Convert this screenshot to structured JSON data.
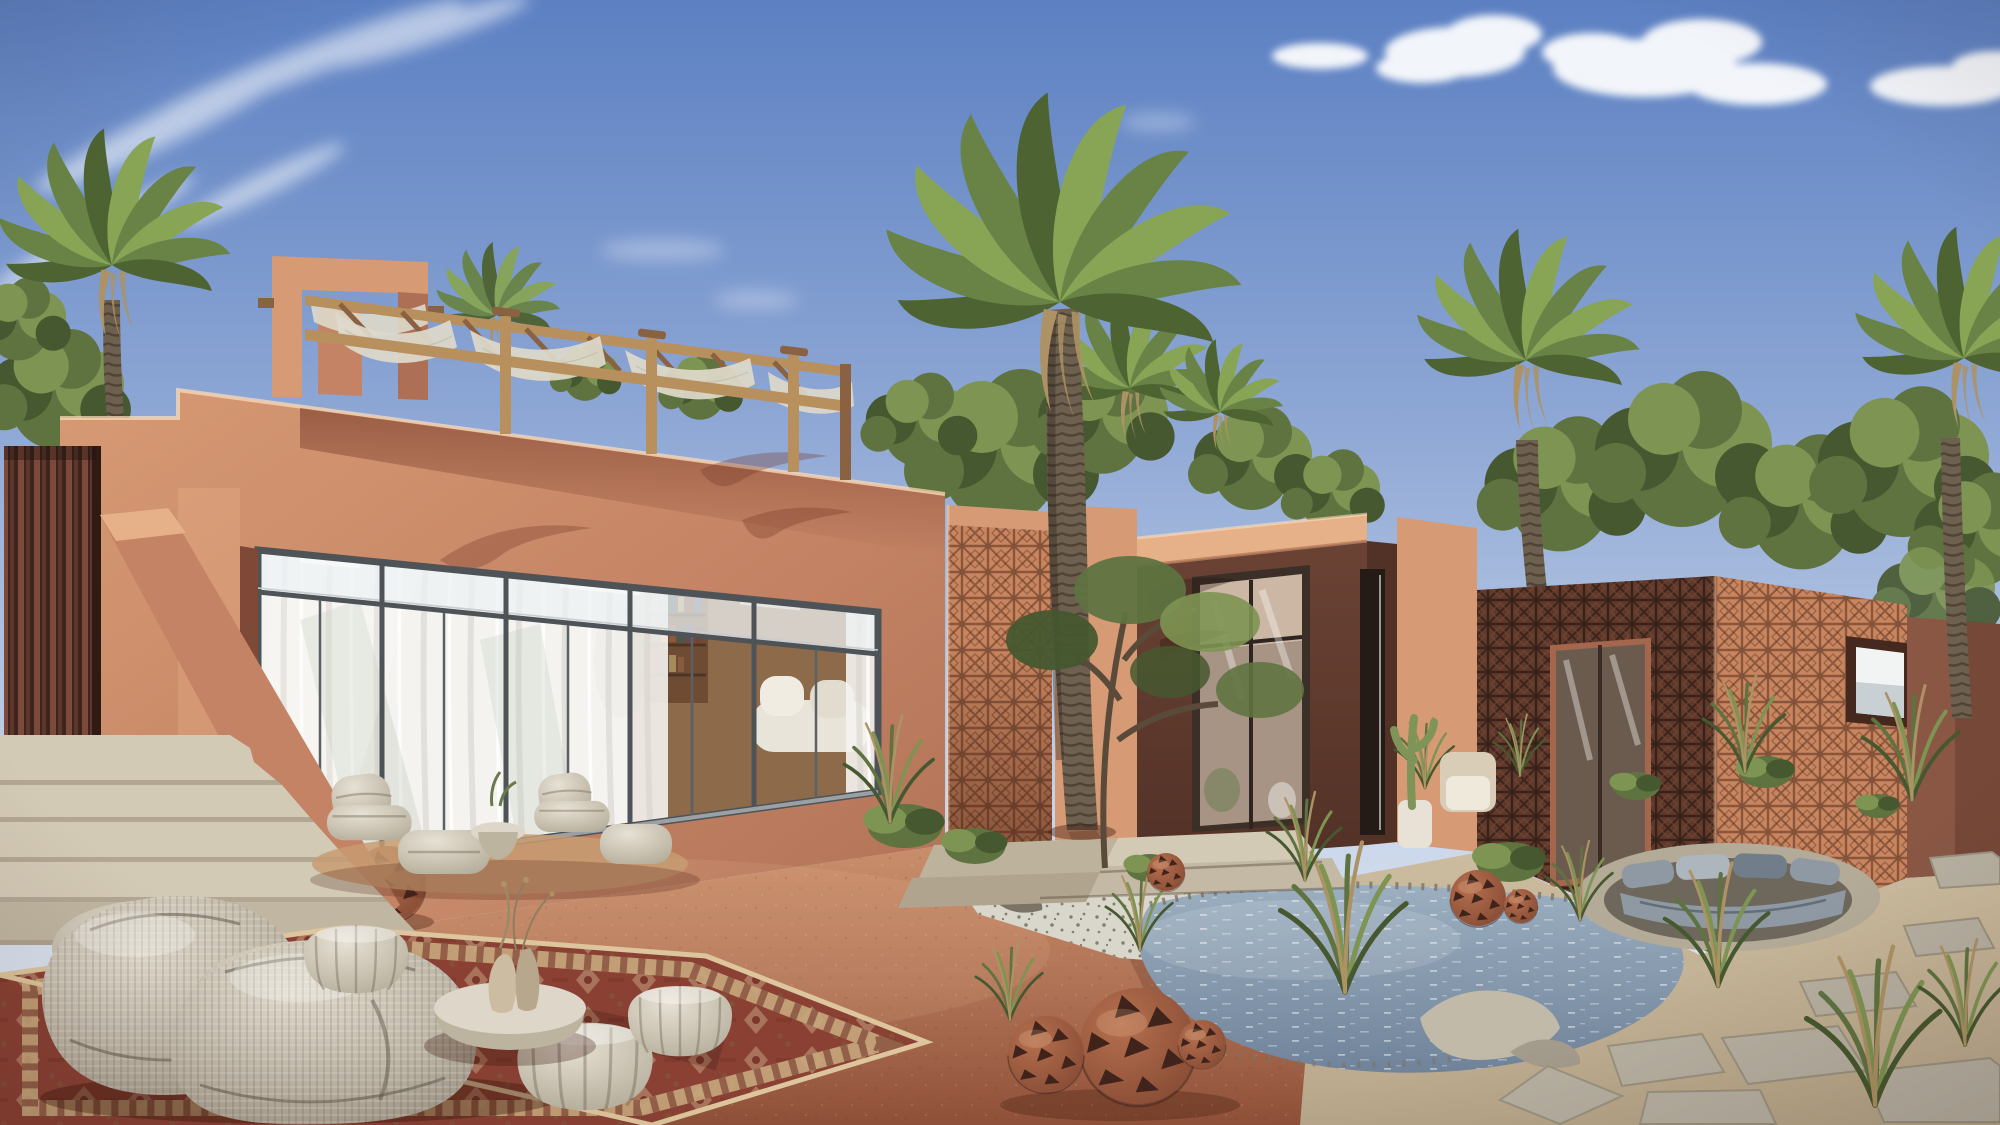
{
  "meta": {
    "title": "Desert adobe villa — photorealistic exterior rendering",
    "description": "Daytime architectural visualization of a terracotta desert residence: main villa with rooftop pergola, perforated claustra-brick pavilions, date palms, natural pond garden and bohemian outdoor lounge with woven bean bags on an oriental rug.",
    "visible_text": "none"
  },
  "palette": {
    "sky_top": "#5c80c2",
    "sky_mid": "#8fa8d5",
    "sky_low": "#c7d4e9",
    "sky_horizon": "#ecf1f6",
    "cloud": "#ffffff",
    "wall_sun": "#d69a74",
    "wall_mid": "#c48364",
    "wall_deep": "#ad6f55",
    "wall_shade": "#99604a",
    "wall_dark": "#7e4936",
    "parapet": "#e6b189",
    "soffit": "#8b4c38",
    "pavilion": "#6b4335",
    "pavilion_dark": "#523126",
    "pavilion_edge": "#b97f5f",
    "claustra_sun": "#c9855f",
    "claustra_sun_cut": "#53301f",
    "claustra_shade": "#5f392c",
    "claustra_shade_cut": "#2f1c15",
    "slat_light": "#7c4a3a",
    "slat_dark": "#3f241d",
    "frame_dark": "#4d5357",
    "frame_light": "#c9cdd0",
    "glass_sky": "#e8eced",
    "curtain": "#f5f3ef",
    "curtain_sh": "#d7d4cd",
    "glass_tree": "#b9bfb2",
    "interior": "#936a46",
    "interior_dark": "#654732",
    "wood": "#b8905e",
    "wood_dark": "#8a6242",
    "fabric": "#ded9ca",
    "tread": "#d3cab6",
    "riser": "#9b907b",
    "step_side": "#c0b6a1",
    "terrace_light": "#c98e6a",
    "terrace_mid": "#b07356",
    "terrace_deep": "#8f5038",
    "gravel": "#d9d6cb",
    "gravel_dot": "#84806e",
    "water_light": "#9cafc0",
    "water_dark": "#70839a",
    "sand": "#b8a78a",
    "sand_light": "#ccbc9f",
    "paver": "#b7b1a2",
    "paver_edge": "#9a937f",
    "rock": "#a49c8c",
    "rock_dark": "#7b7366",
    "rock_light": "#c2baa8",
    "green_dark": "#46582f",
    "green_mid": "#5f7340",
    "green_light": "#7d9452",
    "green_pale": "#96aa6c",
    "palm_dark": "#4d6331",
    "palm_mid": "#688345",
    "palm_light": "#88a556",
    "palm_dry": "#ac9264",
    "trunk": "#6e604f",
    "trunk_dark": "#4f4336",
    "beanbag_hi": "#e2dccd",
    "beanbag_mid": "#bcb4a4",
    "beanbag_lo": "#938b7c",
    "pouf": "#e7e1d4",
    "pouf_lo": "#aca490",
    "table": "#ded7c9",
    "table_lo": "#bdb4a0",
    "vase": "#cbbca2",
    "vase2": "#b7a78c",
    "rug_red": "#8a4134",
    "rug_dark": "#6c2c22",
    "rug_beige": "#c8a87d",
    "rug_cream": "#ddc59d",
    "rug_olive": "#7b5d3d",
    "lantern": "#b56f4e",
    "lantern_lo": "#7e4530",
    "lantern_cut": "#40231b",
    "cushion_l": "#aeb6bd",
    "cushion_m": "#8f99a3",
    "cushion_d": "#717d88"
  },
  "scene": {
    "sky": {
      "condition": "clear blue with wispy cirrus top-left and small cumulus top-right"
    },
    "buildings": [
      {
        "name": "main-villa",
        "features": [
          "stepped adobe parapet",
          "rooftop portal frame",
          "timber pergola with draped shade cloth",
          "full-width sliding glass wall with transom band",
          "sheer white curtains",
          "interior bookshelf and white sofa visible"
        ]
      },
      {
        "name": "claustra-screen-panel",
        "features": [
          "perforated terracotta breeze-block screen linking villa to rear wing"
        ]
      },
      {
        "name": "rear-garden-wing",
        "features": [
          "sunlit adobe parapet behind entry pavilion"
        ]
      },
      {
        "name": "entry-pavilion",
        "features": [
          "shaded chocolate-brown adobe cube",
          "tall dark-framed glass entry door with transom",
          "concrete entry steps"
        ]
      },
      {
        "name": "claustra-guesthouse",
        "features": [
          "full breeze-block facade, shaded and sunlit faces",
          "recessed glass door",
          "deep-framed square window with white glazing"
        ]
      },
      {
        "name": "boundary-wall",
        "features": [
          "plain shaded adobe garden wall at right"
        ]
      }
    ],
    "vegetation": [
      "date palm left of villa",
      "tall date palm in courtyard center",
      "two small palms behind entry pavilion",
      "date palm right of guesthouse",
      "date palm at far right edge",
      "leafy trees behind buildings",
      "olive tree by pond",
      "desert shrubs",
      "ornamental grasses",
      "columnar cactus in white pot"
    ],
    "landscape": [
      "terracotta earth terrace",
      "white gravel bed",
      "natural rock-edged pond with sparkling water",
      "sandy ground with irregular stone pavers",
      "sunken lounge pit with grey cushions",
      "wide concrete stairs bottom-left"
    ],
    "furniture": [
      "two quilted cream lounge chairs with ottomans on round mat",
      "small white side table with plant",
      "two large woven bean-bag chairs",
      "three woven outdoor poufs",
      "round white coffee table with two ceramic vases and dried stems",
      "red oriental rug"
    ],
    "decor": [
      "perforated terracotta sphere lanterns near stairs, entry steps, pond and lounge"
    ]
  }
}
